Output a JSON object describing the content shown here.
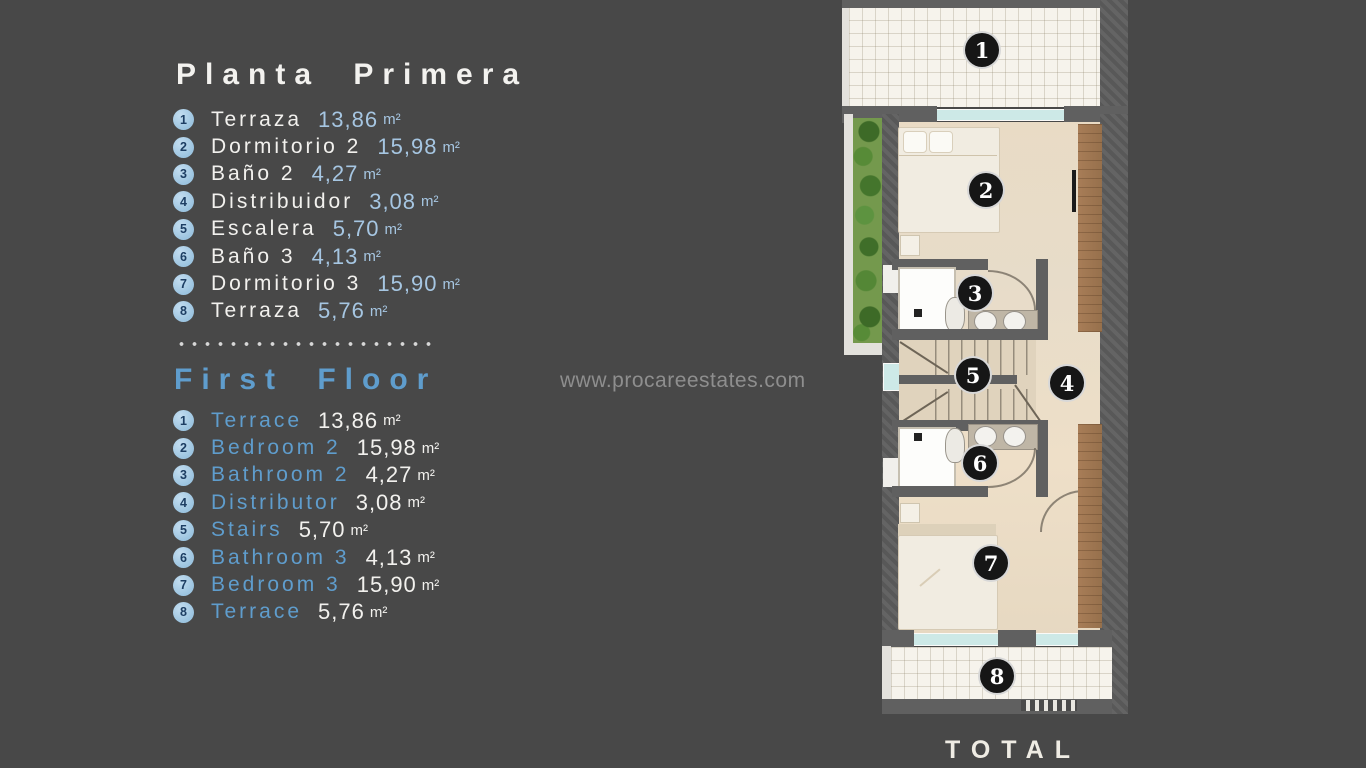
{
  "colors": {
    "background": "#484848",
    "accent_blue": "#5f9dcd",
    "light_blue": "#a6c6e2",
    "text_white": "#f2f1ee",
    "marker_circle": "#a9cde6",
    "plan_wall": "#5d5d5d",
    "plan_floor": "#e8dcc8",
    "wood": "#a37b56",
    "garden_green": "#71994a"
  },
  "left_panel": {
    "unit": "m²",
    "spanish": {
      "title": "Planta Primera",
      "items": [
        {
          "num": "1",
          "name": "Terraza",
          "area": "13,86"
        },
        {
          "num": "2",
          "name": "Dormitorio 2",
          "area": "15,98"
        },
        {
          "num": "3",
          "name": "Baño 2",
          "area": "4,27"
        },
        {
          "num": "4",
          "name": "Distribuidor",
          "area": "3,08"
        },
        {
          "num": "5",
          "name": "Escalera",
          "area": "5,70"
        },
        {
          "num": "6",
          "name": "Baño 3",
          "area": "4,13"
        },
        {
          "num": "7",
          "name": "Dormitorio 3",
          "area": "15,90"
        },
        {
          "num": "8",
          "name": "Terraza",
          "area": "5,76"
        }
      ]
    },
    "english": {
      "title": "First Floor",
      "items": [
        {
          "num": "1",
          "name": "Terrace",
          "area": "13,86"
        },
        {
          "num": "2",
          "name": "Bedroom 2",
          "area": "15,98"
        },
        {
          "num": "3",
          "name": "Bathroom 2",
          "area": "4,27"
        },
        {
          "num": "4",
          "name": "Distributor",
          "area": "3,08"
        },
        {
          "num": "5",
          "name": "Stairs",
          "area": "5,70"
        },
        {
          "num": "6",
          "name": "Bathroom 3",
          "area": "4,13"
        },
        {
          "num": "7",
          "name": "Bedroom 3",
          "area": "15,90"
        },
        {
          "num": "8",
          "name": "Terrace",
          "area": "5,76"
        }
      ]
    }
  },
  "watermark": {
    "text": "www.procareestates.com"
  },
  "plan": {
    "total_label": "TOTAL",
    "markers": [
      {
        "num": "1"
      },
      {
        "num": "2"
      },
      {
        "num": "3"
      },
      {
        "num": "4"
      },
      {
        "num": "5"
      },
      {
        "num": "6"
      },
      {
        "num": "7"
      },
      {
        "num": "8"
      }
    ]
  }
}
